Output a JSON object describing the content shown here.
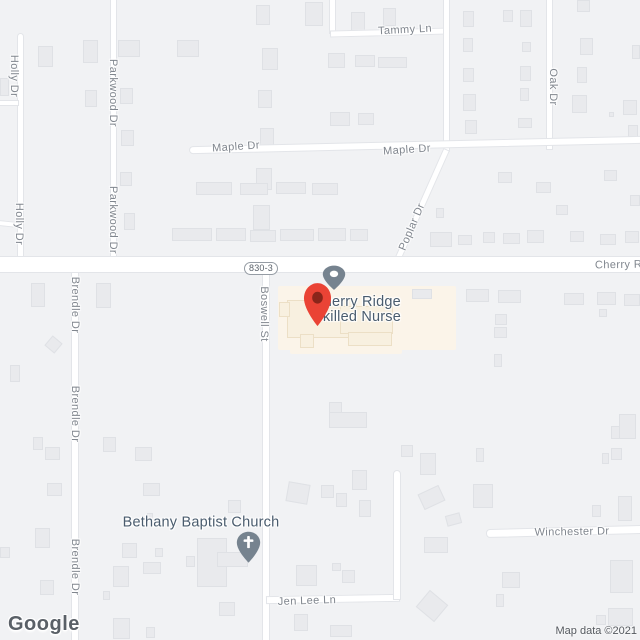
{
  "map": {
    "watermark_text": "Google",
    "attribution_text": "Map data ©2021",
    "route_shield": {
      "text": "830-3"
    },
    "poi": {
      "name_line1": "Cherry Ridge",
      "name_line2": "Skilled Nurse",
      "cx": 357,
      "cy": 295
    },
    "church": {
      "label": "Bethany Baptist Church",
      "cx": 201,
      "cy": 523,
      "icon": "cross-pin-icon"
    },
    "colors": {
      "bg": "#f1f2f4",
      "road-fill": "#ffffff",
      "road-border": "#e3e5e9",
      "building-fill": "#e9eaed",
      "building-border": "#dfe1e5",
      "beige-area": "#fbf4e9",
      "beige-fill": "#f8f0e0",
      "beige-border": "#ecdfc6",
      "label-gray": "#80868e",
      "poi-dark": "#4a5c6e",
      "pin-red": "#ea4335",
      "pin-red-dark": "#8a251a",
      "pin-slate": "#76838f",
      "shield-border": "#959ca4",
      "shield-text": "#5a626b",
      "attribution": "#54585e",
      "watermark": "#5a6067"
    },
    "street_labels": [
      {
        "text": "Holly Dr",
        "x": 14,
        "y": 76,
        "rot": 90
      },
      {
        "text": "Holly Dr",
        "x": 19,
        "y": 224,
        "rot": 90
      },
      {
        "text": "Parkwood Dr",
        "x": 113,
        "y": 93,
        "rot": 90
      },
      {
        "text": "Parkwood Dr",
        "x": 113,
        "y": 220,
        "rot": 90
      },
      {
        "text": "Tammy Ln",
        "x": 405,
        "y": 30,
        "rot": -3
      },
      {
        "text": "Maple Dr",
        "x": 236,
        "y": 147,
        "rot": -4
      },
      {
        "text": "Maple Dr",
        "x": 407,
        "y": 150,
        "rot": -4
      },
      {
        "text": "Oak Dr",
        "x": 553,
        "y": 87,
        "rot": 90
      },
      {
        "text": "Poplar Dr",
        "x": 412,
        "y": 227,
        "rot": -67
      },
      {
        "text": "Cherry Ri",
        "x": 620,
        "y": 265,
        "rot": -1
      },
      {
        "text": "Brendle Dr",
        "x": 75,
        "y": 305,
        "rot": 90
      },
      {
        "text": "Brendle Dr",
        "x": 75,
        "y": 414,
        "rot": 90
      },
      {
        "text": "Brendle Dr",
        "x": 75,
        "y": 567,
        "rot": 90
      },
      {
        "text": "Boswell St",
        "x": 264,
        "y": 314,
        "rot": 90
      },
      {
        "text": "Winchester Dr",
        "x": 572,
        "y": 532,
        "rot": -1
      },
      {
        "text": "Jen Lee Ln",
        "x": 307,
        "y": 601,
        "rot": -2
      }
    ],
    "roads": [
      {
        "x": 17,
        "y": 33,
        "w": 7,
        "h": 227,
        "rot": 0,
        "cap": "top"
      },
      {
        "x": -2,
        "y": 100,
        "w": 21,
        "h": 6,
        "rot": 0
      },
      {
        "x": -2,
        "y": 221,
        "w": 21,
        "h": 6,
        "rot": 6
      },
      {
        "x": 110,
        "y": -2,
        "w": 7,
        "h": 263,
        "rot": 0
      },
      {
        "x": 329,
        "y": -2,
        "w": 7,
        "h": 36,
        "rot": 0
      },
      {
        "x": 330,
        "y": 29,
        "w": 119,
        "h": 7,
        "rot": -1.5
      },
      {
        "x": 443,
        "y": -2,
        "w": 7,
        "h": 154,
        "rot": 0
      },
      {
        "x": 546,
        "y": -2,
        "w": 7,
        "h": 152,
        "rot": 0
      },
      {
        "x": 189,
        "y": 141,
        "w": 455,
        "h": 8,
        "rot": -1.3,
        "cap": "left"
      },
      {
        "x": 418,
        "y": 144,
        "w": 7,
        "h": 124,
        "rot": 24
      },
      {
        "x": -2,
        "y": 256,
        "w": 644,
        "h": 17,
        "rot": 0
      },
      {
        "x": 262,
        "y": 272,
        "w": 8,
        "h": 370,
        "rot": 0
      },
      {
        "x": 71,
        "y": 272,
        "w": 8,
        "h": 370,
        "rot": 0
      },
      {
        "x": 486,
        "y": 527,
        "w": 156,
        "h": 9,
        "rot": -1.5,
        "cap": "left"
      },
      {
        "x": 266,
        "y": 595,
        "w": 134,
        "h": 8,
        "rot": -1
      },
      {
        "x": 393,
        "y": 470,
        "w": 8,
        "h": 130,
        "rot": 0,
        "cap": "top"
      }
    ],
    "poi_areas": [
      [
        278,
        286,
        178,
        64
      ],
      [
        290,
        336,
        112,
        18
      ]
    ],
    "beige_buildings": [
      [
        287,
        300,
        70,
        38
      ],
      [
        340,
        306,
        53,
        28
      ],
      [
        300,
        334,
        14,
        14
      ],
      [
        348,
        332,
        44,
        14
      ],
      [
        279,
        302,
        11,
        15
      ]
    ],
    "buildings": [
      [
        0,
        78,
        9,
        18
      ],
      [
        38,
        46,
        15,
        21
      ],
      [
        83,
        40,
        15,
        23
      ],
      [
        85,
        90,
        12,
        17
      ],
      [
        118,
        40,
        22,
        17
      ],
      [
        120,
        88,
        13,
        16
      ],
      [
        121,
        130,
        13,
        16
      ],
      [
        120,
        172,
        12,
        14
      ],
      [
        124,
        213,
        11,
        17
      ],
      [
        177,
        40,
        22,
        17
      ],
      [
        305,
        2,
        18,
        24
      ],
      [
        256,
        5,
        14,
        20
      ],
      [
        262,
        48,
        16,
        22
      ],
      [
        258,
        90,
        14,
        18
      ],
      [
        260,
        128,
        14,
        20
      ],
      [
        256,
        168,
        16,
        22
      ],
      [
        253,
        205,
        17,
        25
      ],
      [
        196,
        182,
        36,
        13
      ],
      [
        240,
        183,
        28,
        12
      ],
      [
        276,
        182,
        30,
        12
      ],
      [
        312,
        183,
        26,
        12
      ],
      [
        172,
        228,
        40,
        13
      ],
      [
        216,
        228,
        30,
        13
      ],
      [
        250,
        230,
        26,
        12
      ],
      [
        280,
        229,
        34,
        12
      ],
      [
        318,
        228,
        28,
        13
      ],
      [
        350,
        229,
        18,
        12
      ],
      [
        351,
        12,
        14,
        20
      ],
      [
        383,
        8,
        13,
        18
      ],
      [
        328,
        53,
        17,
        15
      ],
      [
        355,
        55,
        20,
        12
      ],
      [
        378,
        57,
        29,
        11
      ],
      [
        330,
        112,
        20,
        14
      ],
      [
        358,
        113,
        16,
        12
      ],
      [
        463,
        11,
        11,
        16
      ],
      [
        503,
        10,
        10,
        12
      ],
      [
        520,
        10,
        12,
        17
      ],
      [
        463,
        38,
        10,
        14
      ],
      [
        522,
        42,
        9,
        10
      ],
      [
        463,
        68,
        11,
        14
      ],
      [
        520,
        66,
        11,
        15
      ],
      [
        520,
        88,
        9,
        13
      ],
      [
        463,
        94,
        13,
        17
      ],
      [
        518,
        118,
        14,
        10
      ],
      [
        465,
        120,
        12,
        14
      ],
      [
        577,
        0,
        13,
        12
      ],
      [
        580,
        38,
        13,
        17
      ],
      [
        577,
        67,
        10,
        16
      ],
      [
        572,
        95,
        15,
        18
      ],
      [
        623,
        100,
        14,
        15
      ],
      [
        632,
        45,
        8,
        14
      ],
      [
        628,
        125,
        10,
        12
      ],
      [
        609,
        112,
        5,
        5
      ],
      [
        436,
        208,
        8,
        10
      ],
      [
        430,
        232,
        22,
        15
      ],
      [
        458,
        235,
        14,
        10
      ],
      [
        483,
        232,
        12,
        11
      ],
      [
        498,
        172,
        14,
        11
      ],
      [
        536,
        182,
        15,
        11
      ],
      [
        604,
        170,
        13,
        11
      ],
      [
        630,
        195,
        10,
        11
      ],
      [
        556,
        205,
        12,
        10
      ],
      [
        503,
        233,
        17,
        11
      ],
      [
        527,
        230,
        17,
        13
      ],
      [
        570,
        231,
        14,
        11
      ],
      [
        600,
        234,
        16,
        11
      ],
      [
        625,
        231,
        14,
        12
      ],
      [
        412,
        289,
        20,
        10
      ],
      [
        466,
        289,
        23,
        13
      ],
      [
        498,
        290,
        23,
        13
      ],
      [
        564,
        293,
        20,
        12
      ],
      [
        597,
        292,
        19,
        13
      ],
      [
        624,
        294,
        16,
        12
      ],
      [
        495,
        314,
        12,
        11
      ],
      [
        494,
        327,
        13,
        11
      ],
      [
        599,
        309,
        8,
        8
      ],
      [
        494,
        354,
        8,
        13
      ],
      [
        31,
        283,
        14,
        24
      ],
      [
        47,
        338,
        13,
        13,
        40
      ],
      [
        10,
        365,
        10,
        17
      ],
      [
        33,
        437,
        10,
        13
      ],
      [
        45,
        447,
        15,
        13
      ],
      [
        47,
        483,
        15,
        13
      ],
      [
        35,
        528,
        15,
        20
      ],
      [
        40,
        580,
        14,
        15
      ],
      [
        0,
        547,
        10,
        11
      ],
      [
        96,
        283,
        15,
        25
      ],
      [
        103,
        437,
        13,
        15
      ],
      [
        135,
        447,
        17,
        14
      ],
      [
        143,
        483,
        17,
        13
      ],
      [
        122,
        543,
        15,
        15
      ],
      [
        113,
        566,
        16,
        21
      ],
      [
        155,
        548,
        8,
        9
      ],
      [
        103,
        591,
        7,
        9
      ],
      [
        329,
        402,
        13,
        26
      ],
      [
        329,
        412,
        38,
        16
      ],
      [
        287,
        483,
        22,
        20,
        10
      ],
      [
        321,
        485,
        13,
        13
      ],
      [
        352,
        470,
        15,
        20
      ],
      [
        336,
        493,
        11,
        14
      ],
      [
        359,
        500,
        12,
        17
      ],
      [
        228,
        500,
        13,
        13
      ],
      [
        420,
        453,
        16,
        22
      ],
      [
        420,
        489,
        23,
        17,
        -25
      ],
      [
        446,
        514,
        15,
        11,
        -15
      ],
      [
        473,
        484,
        20,
        24
      ],
      [
        476,
        448,
        8,
        14
      ],
      [
        401,
        445,
        12,
        12
      ],
      [
        592,
        505,
        9,
        12
      ],
      [
        618,
        496,
        14,
        25
      ],
      [
        602,
        453,
        7,
        11
      ],
      [
        611,
        448,
        11,
        12
      ],
      [
        619,
        414,
        17,
        25
      ],
      [
        611,
        426,
        9,
        13
      ],
      [
        424,
        537,
        24,
        16
      ],
      [
        420,
        595,
        24,
        22,
        40
      ],
      [
        502,
        572,
        18,
        16
      ],
      [
        496,
        594,
        8,
        13
      ],
      [
        610,
        560,
        23,
        33
      ],
      [
        608,
        608,
        25,
        18
      ],
      [
        596,
        615,
        10,
        10
      ],
      [
        296,
        565,
        21,
        21
      ],
      [
        332,
        563,
        9,
        8
      ],
      [
        342,
        570,
        13,
        13
      ],
      [
        294,
        614,
        14,
        17
      ],
      [
        330,
        625,
        22,
        12
      ],
      [
        113,
        618,
        17,
        21
      ],
      [
        146,
        627,
        9,
        11
      ],
      [
        219,
        602,
        16,
        14
      ],
      [
        197,
        538,
        30,
        49
      ],
      [
        217,
        552,
        31,
        15
      ],
      [
        186,
        556,
        9,
        11
      ],
      [
        143,
        562,
        18,
        12
      ],
      [
        147,
        513,
        6,
        7
      ]
    ],
    "pins": {
      "destination": {
        "x": 303,
        "y": 282,
        "w": 29,
        "h": 46
      },
      "poi_small": {
        "x": 322,
        "y": 265,
        "w": 24,
        "h": 26
      },
      "church": {
        "x": 236,
        "y": 531,
        "w": 25,
        "h": 33
      }
    }
  }
}
